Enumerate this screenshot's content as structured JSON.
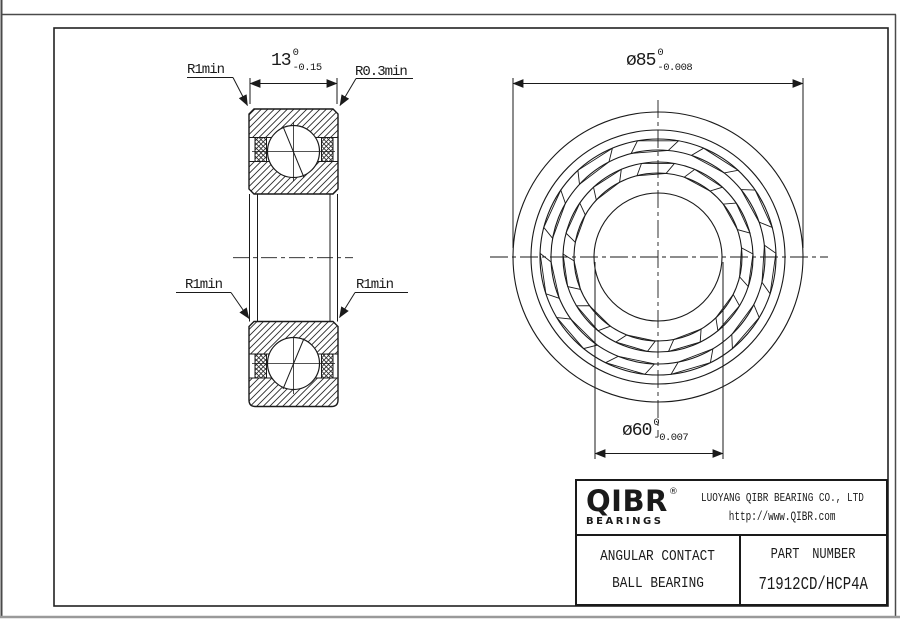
{
  "drawing": {
    "section_view": {
      "label_r1min_top": "R1min",
      "label_r03min": "R0.3min",
      "label_r1min_left": "R1min",
      "label_r1min_right": "R1min",
      "width_dim": {
        "value": "13",
        "tol_upper": "0",
        "tol_lower": "-0.15"
      }
    },
    "front_view": {
      "outer_dia_dim": {
        "value": "ø85",
        "tol_upper": "0",
        "tol_lower": "-0.008"
      },
      "bore_dia_dim": {
        "value": "ø60",
        "tol_upper": "0",
        "tol_lower": "-0.007"
      }
    }
  },
  "title_block": {
    "brand": "QIBR",
    "registered_mark": "®",
    "brand_sub": "BEARINGS",
    "company": "LUOYANG QIBR BEARING CO., LTD",
    "website": "http://www.QIBR.com",
    "product_type_line1": "ANGULAR CONTACT",
    "product_type_line2": "BALL BEARING",
    "part_number_label": "PART NUMBER",
    "part_number": "71912CD/HCP4A"
  },
  "colors": {
    "line": "#1a1a1a",
    "background": "#ffffff"
  }
}
